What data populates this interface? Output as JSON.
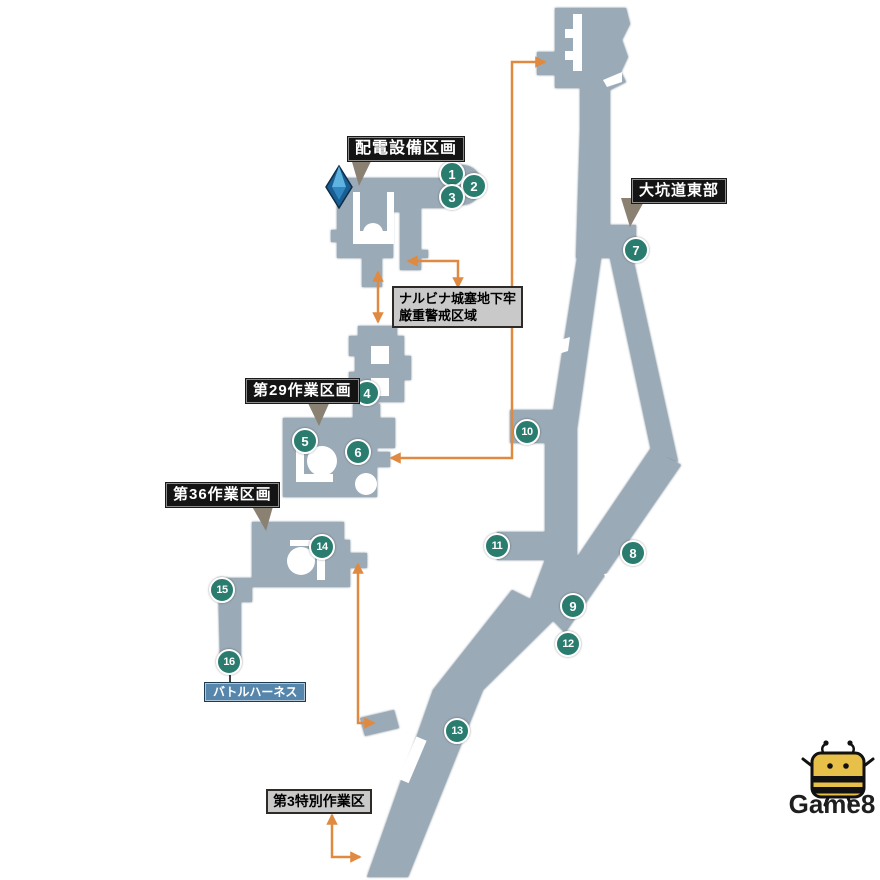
{
  "area_labels": {
    "power_section": "配電設備区画",
    "tunnel_east": "大坑道東部",
    "work_29": "第29作業区画",
    "work_36": "第36作業区画"
  },
  "info_boxes": {
    "nalbina": {
      "line1": "ナルビナ城塞地下牢",
      "line2": "厳重警戒区域"
    },
    "special_work_3": {
      "line1": "第3特別作業区"
    }
  },
  "item_label": {
    "text": "バトルハーネス"
  },
  "markers": [
    {
      "n": "1",
      "x": 452,
      "y": 174
    },
    {
      "n": "2",
      "x": 474,
      "y": 186
    },
    {
      "n": "3",
      "x": 452,
      "y": 197
    },
    {
      "n": "4",
      "x": 367,
      "y": 393
    },
    {
      "n": "5",
      "x": 305,
      "y": 441
    },
    {
      "n": "6",
      "x": 358,
      "y": 452
    },
    {
      "n": "7",
      "x": 636,
      "y": 250
    },
    {
      "n": "8",
      "x": 633,
      "y": 553
    },
    {
      "n": "9",
      "x": 573,
      "y": 606
    },
    {
      "n": "10",
      "x": 527,
      "y": 432
    },
    {
      "n": "11",
      "x": 497,
      "y": 546
    },
    {
      "n": "12",
      "x": 568,
      "y": 644
    },
    {
      "n": "13",
      "x": 457,
      "y": 731
    },
    {
      "n": "14",
      "x": 322,
      "y": 547
    },
    {
      "n": "15",
      "x": 222,
      "y": 590
    },
    {
      "n": "16",
      "x": 229,
      "y": 662
    }
  ],
  "icons": {
    "save_crystal": "blue-gem-crystal",
    "mascot": "game8-bee"
  },
  "logo": {
    "text": "Game8"
  },
  "colors": {
    "map_fill": "#9BAAB7",
    "marker_teal": "#2A7C6F",
    "arrow_orange": "#E08A41",
    "pointer_gray": "#8A8173",
    "label_black": "#141414",
    "info_gray": "#C9C9C9",
    "item_blue": "#5686AC",
    "bee_yellow": "#E7C04A"
  }
}
